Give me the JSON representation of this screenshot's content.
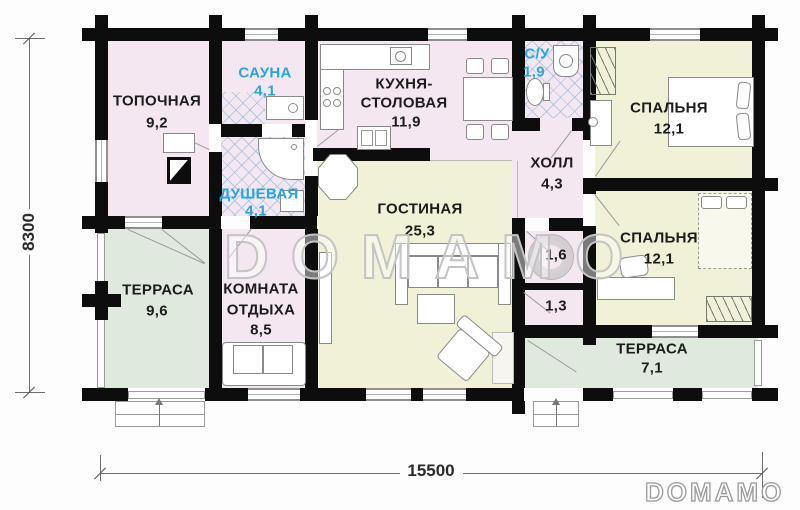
{
  "plan": {
    "watermark_text": "DOMAMO",
    "logo_text": "DOMAMO",
    "dimensions": {
      "total_width_mm": "15500",
      "total_height_mm": "8300"
    },
    "rooms": [
      {
        "id": "topochnaya",
        "name": "ТОПОЧНАЯ",
        "area": "9,2"
      },
      {
        "id": "sauna",
        "name": "САУНА",
        "area": "4,1",
        "accent": true
      },
      {
        "id": "dushevaya",
        "name": "ДУШЕВАЯ",
        "area": "4,1",
        "accent": true
      },
      {
        "id": "kitchen",
        "name_line1": "КУХНЯ-",
        "name_line2": "СТОЛОВАЯ",
        "area": "11,9"
      },
      {
        "id": "su",
        "name": "С/У",
        "area": "1,9",
        "accent": true
      },
      {
        "id": "hall",
        "name": "ХОЛЛ",
        "area": "4,3"
      },
      {
        "id": "bedroom1",
        "name": "СПАЛЬНЯ",
        "area": "12,1"
      },
      {
        "id": "bedroom2",
        "name": "СПАЛЬНЯ",
        "area": "12,1"
      },
      {
        "id": "living",
        "name": "ГОСТИНАЯ",
        "area": "25,3"
      },
      {
        "id": "closet-16",
        "area": "1,6"
      },
      {
        "id": "closet-13",
        "area": "1,3"
      },
      {
        "id": "terrace-left",
        "name": "ТЕРРАСА",
        "area": "9,6"
      },
      {
        "id": "lounge",
        "name_line1": "КОМНАТА",
        "name_line2": "ОТДЫХА",
        "area": "8,5"
      },
      {
        "id": "terrace-right",
        "name": "ТЕРРАСА",
        "area": "7,1"
      }
    ],
    "colors": {
      "wall": "#0d0d0d",
      "room_pink": "#f5e7f2",
      "room_yellow": "#f0f1d6",
      "terrace_green": "#dfe9dd",
      "tile_blue": "#90bade",
      "accent_label": "#27a6dc",
      "watermark_gray": "#c4c4c4"
    },
    "furniture_icons": [
      "boiler-icon",
      "sauna-bench-icon",
      "shower-cabin-icon",
      "stove-icon",
      "kitchen-sink-icon",
      "dining-table-icon",
      "toilet-icon",
      "washbasin-icon",
      "bed-icon",
      "wardrobe-icon",
      "sofa-icon",
      "armchair-icon",
      "coffee-table-icon",
      "tv-stand-icon",
      "desk-icon",
      "water-heater-icon",
      "entrance-steps-icon"
    ]
  }
}
